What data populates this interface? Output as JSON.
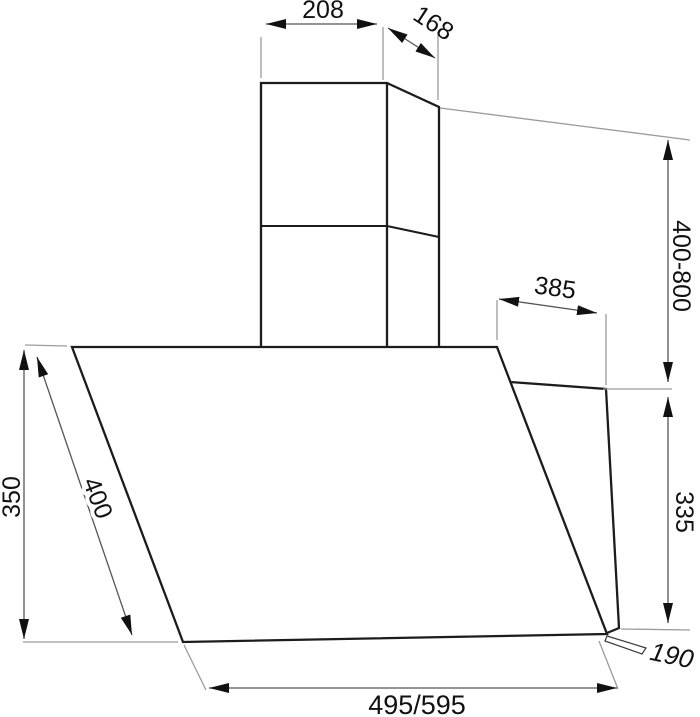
{
  "diagram": {
    "kind": "technical-dimension-drawing",
    "dimensions": {
      "chimney_top_width": "208",
      "chimney_top_depth": "168",
      "chimney_height_range": "400-800",
      "hood_top_depth": "385",
      "hood_front_height": "350",
      "hood_front_slant_length": "400",
      "hood_rear_height": "335",
      "hood_bottom_lip_depth": "190",
      "hood_width": "495/595"
    },
    "colors": {
      "background": "#ffffff",
      "outline": "#1c1c1c",
      "dimension_line": "#555555",
      "extension_line": "#9b9b9b",
      "arrow": "#111111",
      "text": "#111111"
    }
  }
}
